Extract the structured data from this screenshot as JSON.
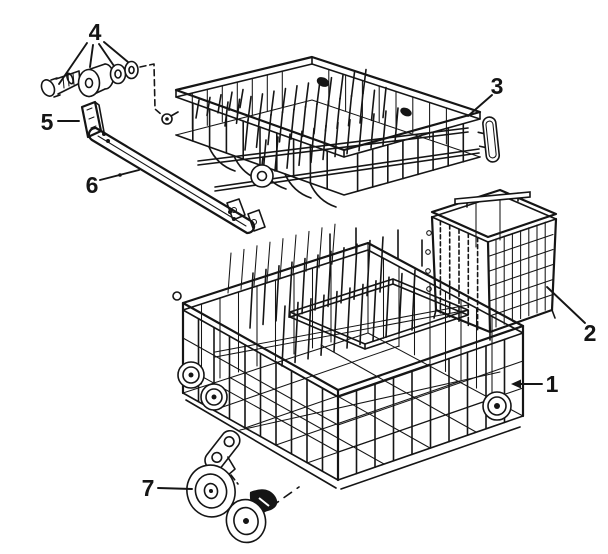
{
  "diagram": {
    "background_color": "#ffffff",
    "line_color": "#151515",
    "callouts": {
      "lower_rack": "1",
      "silverware_basket": "2",
      "upper_rack": "3",
      "mounting_hardware": "4",
      "track_clip": "5",
      "track_rail": "6",
      "wheel_assembly": "7"
    }
  }
}
